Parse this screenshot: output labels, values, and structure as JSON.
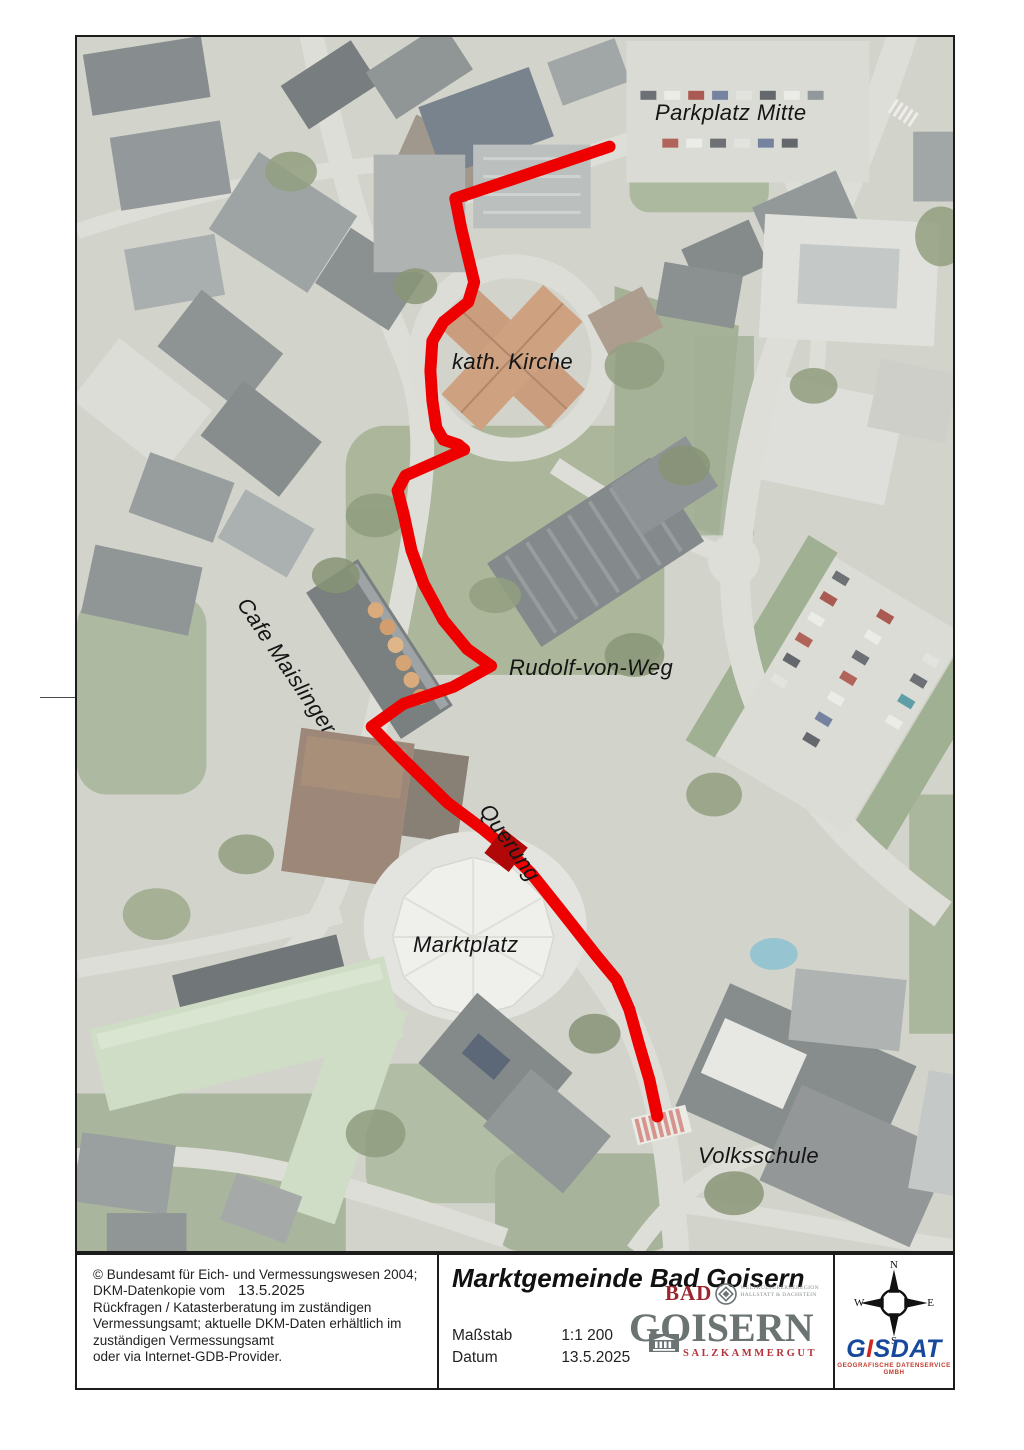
{
  "map": {
    "labels": [
      {
        "id": "parkplatz-mitte",
        "text": "Parkplatz Mitte",
        "x": 578,
        "y": 63,
        "rotation": 0
      },
      {
        "id": "kath-kirche",
        "text": "kath. Kirche",
        "x": 375,
        "y": 312,
        "rotation": 0
      },
      {
        "id": "cafe-maislinger",
        "text": "Cafe Maislinger",
        "x": 176,
        "y": 556,
        "rotation": 56
      },
      {
        "id": "rudolf-von-weg",
        "text": "Rudolf-von-Weg",
        "x": 432,
        "y": 618,
        "rotation": 0
      },
      {
        "id": "querung",
        "text": "Querung",
        "x": 418,
        "y": 762,
        "rotation": 55
      },
      {
        "id": "marktplatz",
        "text": "Marktplatz",
        "x": 336,
        "y": 895,
        "rotation": 0
      },
      {
        "id": "volksschule",
        "text": "Volksschule",
        "x": 621,
        "y": 1106,
        "rotation": 0
      }
    ],
    "route": {
      "color": "#ee0000",
      "points": [
        [
          535,
          110
        ],
        [
          380,
          162
        ],
        [
          386,
          192
        ],
        [
          399,
          246
        ],
        [
          393,
          266
        ],
        [
          368,
          286
        ],
        [
          357,
          305
        ],
        [
          355,
          335
        ],
        [
          357,
          365
        ],
        [
          361,
          392
        ],
        [
          368,
          404
        ],
        [
          383,
          409
        ],
        [
          389,
          414
        ],
        [
          330,
          440
        ],
        [
          322,
          455
        ],
        [
          328,
          478
        ],
        [
          336,
          515
        ],
        [
          348,
          548
        ],
        [
          368,
          585
        ],
        [
          392,
          614
        ],
        [
          416,
          631
        ],
        [
          378,
          652
        ],
        [
          328,
          669
        ],
        [
          296,
          692
        ],
        [
          325,
          722
        ],
        [
          372,
          768
        ],
        [
          408,
          795
        ],
        [
          430,
          813
        ],
        [
          457,
          840
        ],
        [
          485,
          875
        ],
        [
          522,
          922
        ],
        [
          542,
          946
        ],
        [
          555,
          976
        ],
        [
          565,
          1012
        ],
        [
          575,
          1046
        ],
        [
          583,
          1083
        ]
      ]
    },
    "crossing_marker": {
      "x": 431,
      "y": 816,
      "size": 31,
      "rotation": 38,
      "color": "#b00808"
    }
  },
  "footer": {
    "copyright": {
      "line1": "© Bundesamt für Eich- und Vermessungswesen 2004;",
      "line2_prefix": "DKM-Datenkopie vom",
      "line2_date": "13.5.2025",
      "line3": "Rückfragen / Katasterberatung im zuständigen",
      "line4": "Vermessungsamt; aktuelle DKM-Daten erhältlich im",
      "line5": "zuständigen Vermessungsamt",
      "line6": "oder via Internet-GDB-Provider."
    },
    "title": "Marktgemeinde Bad Goisern",
    "scale_label": "Maßstab",
    "scale_value": "1:1 200",
    "date_label": "Datum",
    "date_value": "13.5.2025",
    "bad_goisern_logo": {
      "line1": "BAD",
      "line2": "GOISERN",
      "line3": "SALZKAMMERGUT",
      "heritage_line1": "WELTKULTURERBEREGION",
      "heritage_line2": "HALLSTATT & DACHSTEIN"
    },
    "compass": {
      "north": "N",
      "south": "S",
      "east": "E",
      "west": "W"
    },
    "gisdat_logo": {
      "prefix": "G",
      "accent": "I",
      "suffix": "SDAT",
      "subtitle": "GEOGRAFISCHE DATENSERVICE GMBH"
    }
  }
}
